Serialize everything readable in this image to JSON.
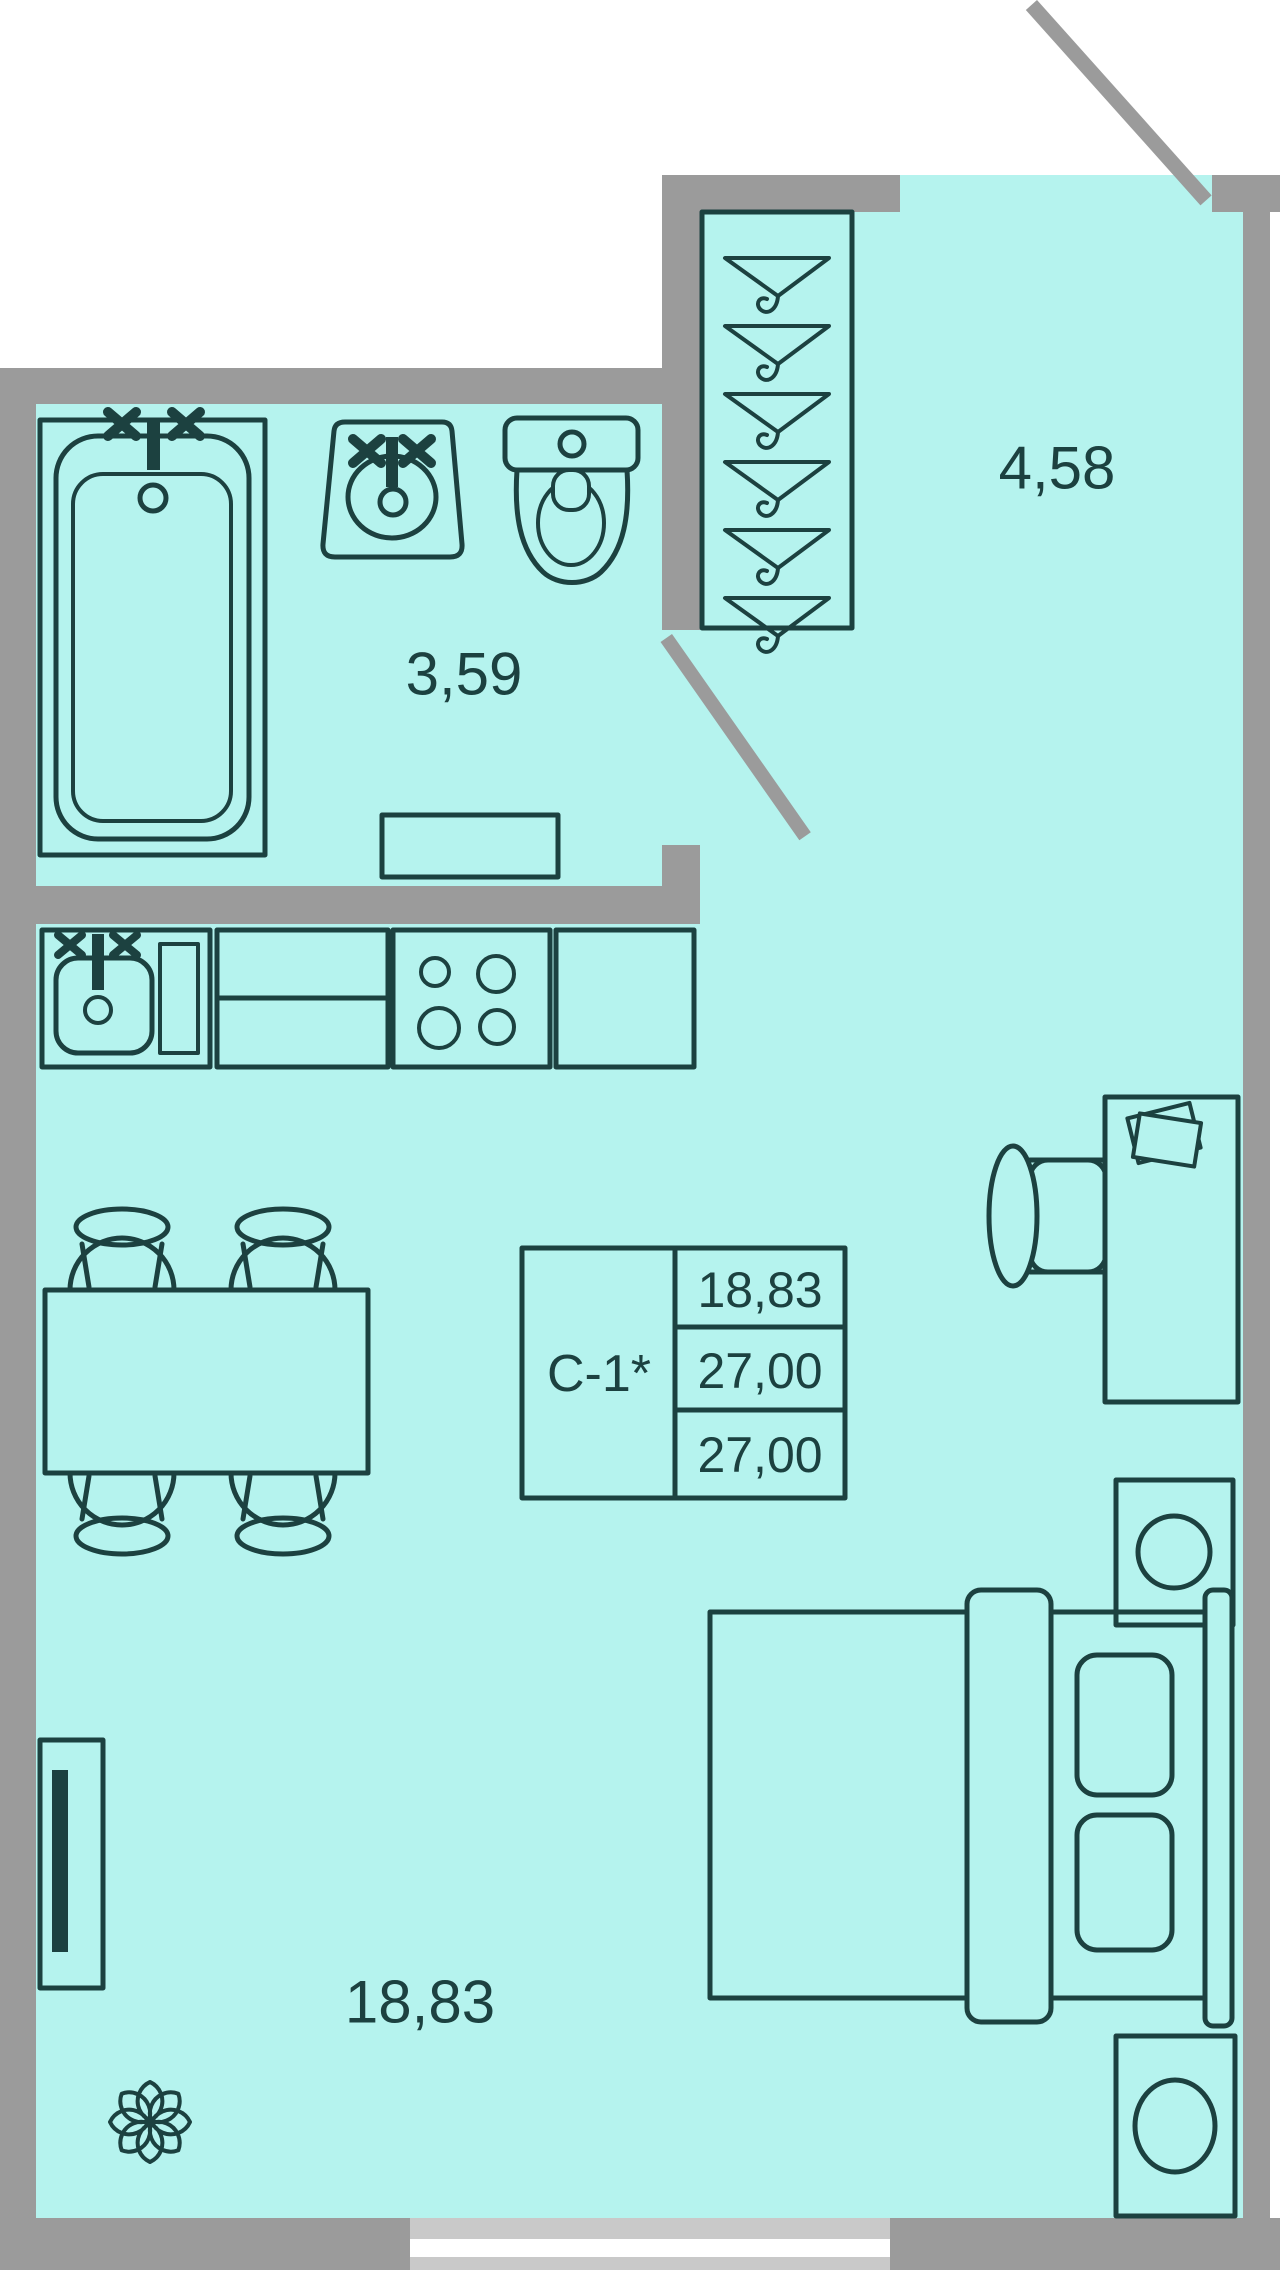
{
  "colors": {
    "bg": "#ffffff",
    "floor": "#b5f3ee",
    "wall": "#9b9b9b",
    "window": "#c9c9c9",
    "glass": "#ffffff",
    "line": "#1c4140",
    "text": "#1c4140"
  },
  "plan": {
    "rooms": [
      {
        "id": "hallway",
        "area": "4,58"
      },
      {
        "id": "bathroom",
        "area": "3,59"
      },
      {
        "id": "living-room",
        "area": "18,83"
      }
    ],
    "stamp": {
      "unit": "С-1*",
      "values": [
        "18,83",
        "27,00",
        "27,00"
      ]
    }
  }
}
